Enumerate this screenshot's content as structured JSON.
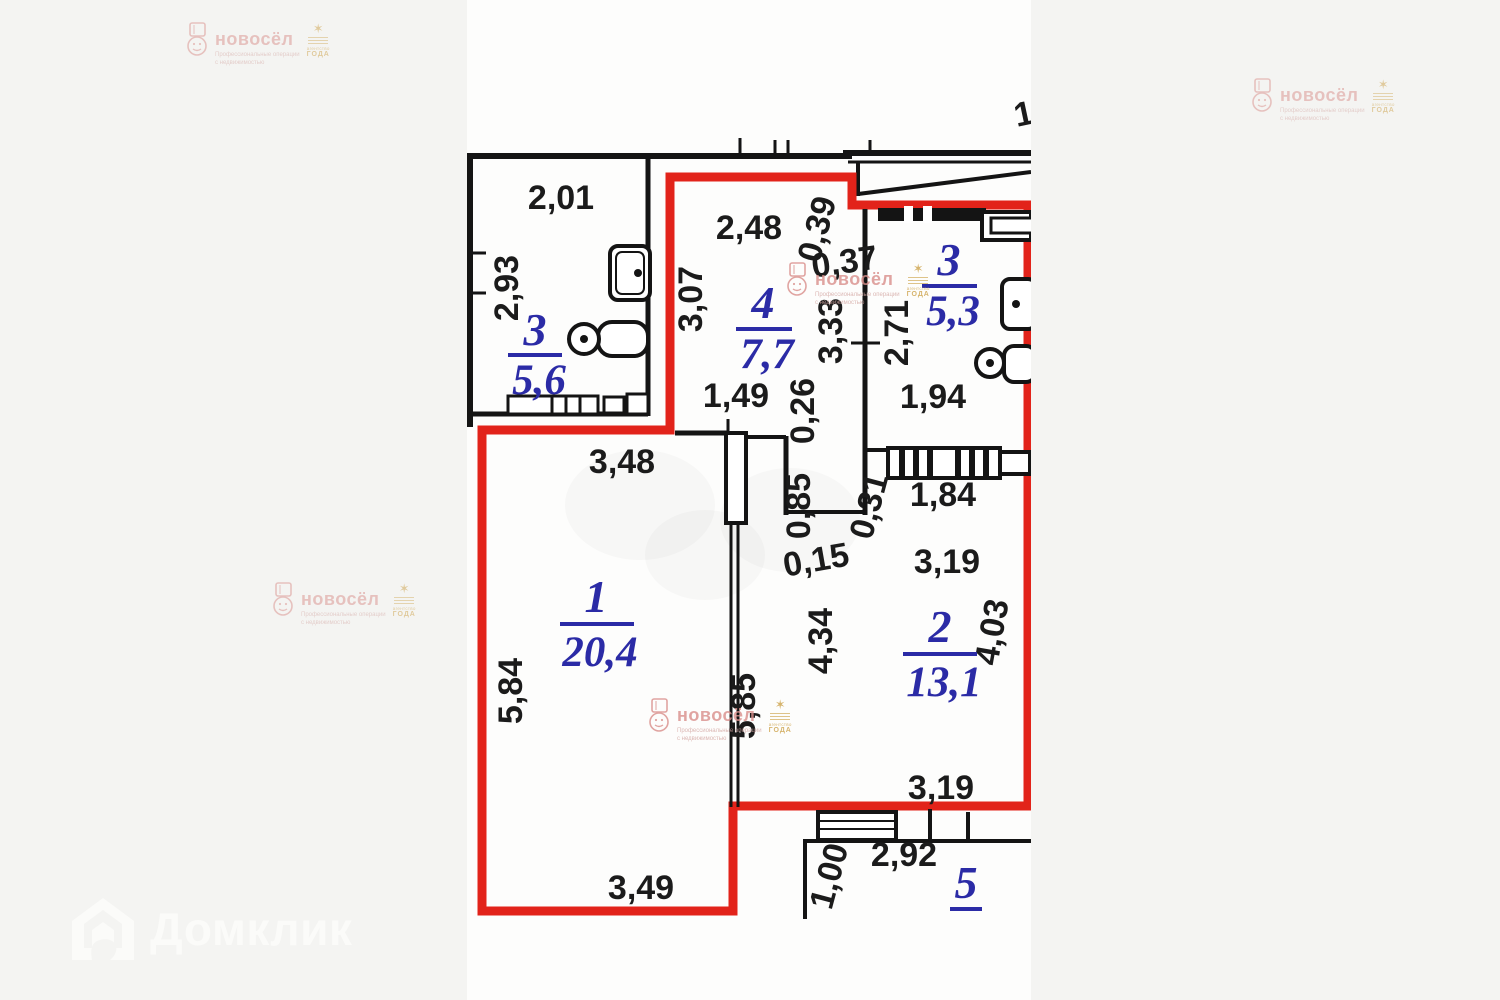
{
  "page": {
    "background": "#f4f4f2",
    "photo_background": "#fdfdfc"
  },
  "branding": {
    "novosel": {
      "name": "новосёл",
      "tagline_line1": "Профессиональные операции",
      "tagline_line2": "с недвижимостью",
      "award_top": "агентство",
      "award_bottom": "ГОДА",
      "text_color": "#d98f8b",
      "gold_color": "#cda24a"
    },
    "domclick": {
      "name": "Домклик",
      "color": "#fbfbf9"
    }
  },
  "floor_plan": {
    "outline_color": "#e2231a",
    "wall_color": "#141414",
    "room_label_color": "#2b2ba6",
    "rooms": [
      {
        "number": "3",
        "area": "5,6"
      },
      {
        "number": "4",
        "area": "7,7"
      },
      {
        "number": "3",
        "area": "5,3"
      },
      {
        "number": "1",
        "area": "20,4"
      },
      {
        "number": "2",
        "area": "13,1"
      },
      {
        "number": "5",
        "area": ""
      }
    ],
    "dims": {
      "w201": "2,01",
      "w293": "2,93",
      "w248": "2,48",
      "w307": "3,07",
      "w039": "0,39",
      "w037": "0,37",
      "w333": "3,33",
      "w271": "2,71",
      "w194": "1,94",
      "w149": "1,49",
      "w026": "0,26",
      "w348": "3,48",
      "w085": "0,85",
      "w031": "0,31",
      "w184": "1,84",
      "w015": "0,15",
      "w319a": "3,19",
      "w584": "5,84",
      "w585": "5,85",
      "w434": "4,34",
      "w403": "4,03",
      "w319b": "3,19",
      "w349": "3,49",
      "w100": "1,00",
      "w292": "2,92",
      "partial_top_right": "1"
    }
  }
}
